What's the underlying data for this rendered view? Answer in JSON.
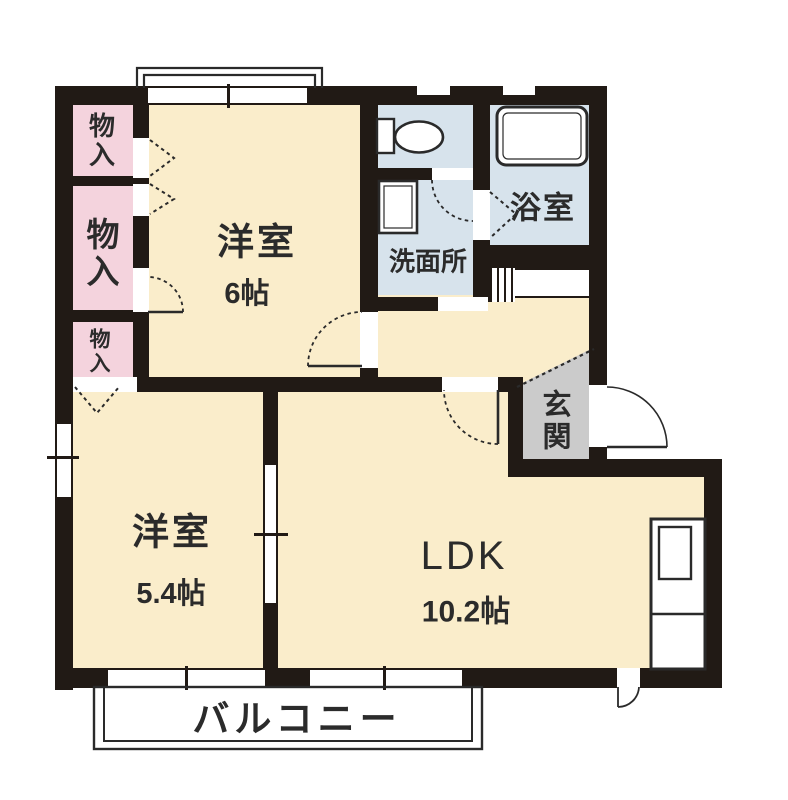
{
  "title": "2LDK apartment floor plan",
  "colors": {
    "wall": "#211a15",
    "room": "#FAEDCB",
    "closet": "#F4D3DD",
    "wet": "#D7E3EC",
    "entry": "#CBCBCB",
    "line": "#2a2a2a",
    "text": "#2b2b2b"
  },
  "rooms": {
    "bedroom1": {
      "label": "洋室",
      "area": "6帖"
    },
    "bedroom2": {
      "label": "洋室",
      "area": "5.4帖"
    },
    "ldk": {
      "label": "LDK",
      "area": "10.2帖"
    },
    "washroom": {
      "label": "洗面所"
    },
    "bathroom": {
      "label": "浴室"
    },
    "entrance": {
      "label": "玄関"
    },
    "balcony": {
      "label": "バルコニー"
    },
    "closet1": {
      "label": "物入"
    },
    "closet2": {
      "label": "物入"
    },
    "closet3": {
      "label": "物入"
    }
  },
  "fixtures": {
    "toilet": "toilet",
    "bathtub": "bathtub",
    "washbasin": "washbasin",
    "kitchen_counter": "kitchen-counter"
  }
}
